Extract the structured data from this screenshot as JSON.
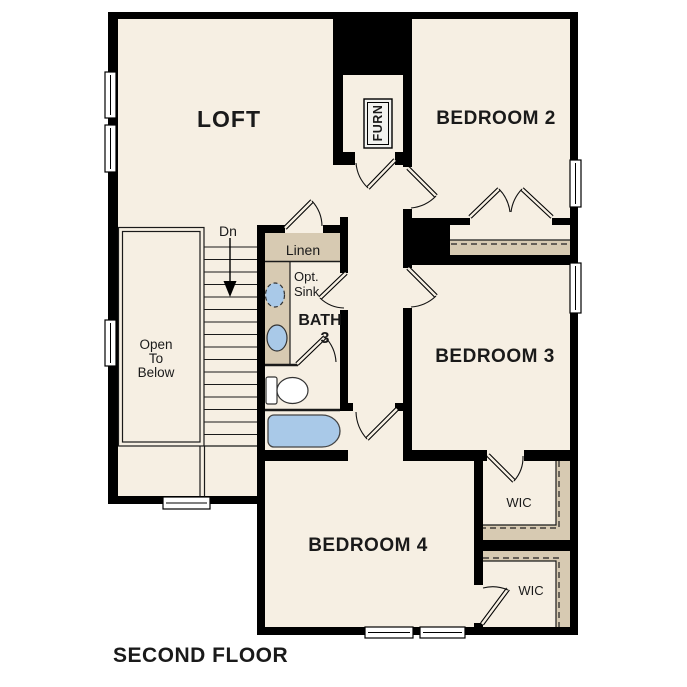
{
  "page_title": "SECOND FLOOR",
  "colors": {
    "wall": "#000000",
    "floor": "#F6EFE3",
    "shelf": "#D7CAB2",
    "fixture_blue": "#A9C9E8",
    "text": "#1A1A1A"
  },
  "rooms": {
    "loft": {
      "label": "LOFT"
    },
    "bedroom2": {
      "label": "BEDROOM 2"
    },
    "bedroom3": {
      "label": "BEDROOM 3"
    },
    "bedroom4": {
      "label": "BEDROOM 4"
    },
    "bath3": {
      "label_line1": "BATH",
      "label_line2": "3",
      "optional_sink_line1": "Opt.",
      "optional_sink_line2": "Sink"
    },
    "linen_closet": {
      "label": "Linen"
    },
    "wic_upper": {
      "label": "WIC"
    },
    "wic_lower": {
      "label": "WIC"
    },
    "open_to_below": {
      "line1": "Open",
      "line2": "To",
      "line3": "Below"
    },
    "furnace_closet": {
      "label": "FURN"
    },
    "stairs": {
      "direction_label": "Dn"
    }
  }
}
